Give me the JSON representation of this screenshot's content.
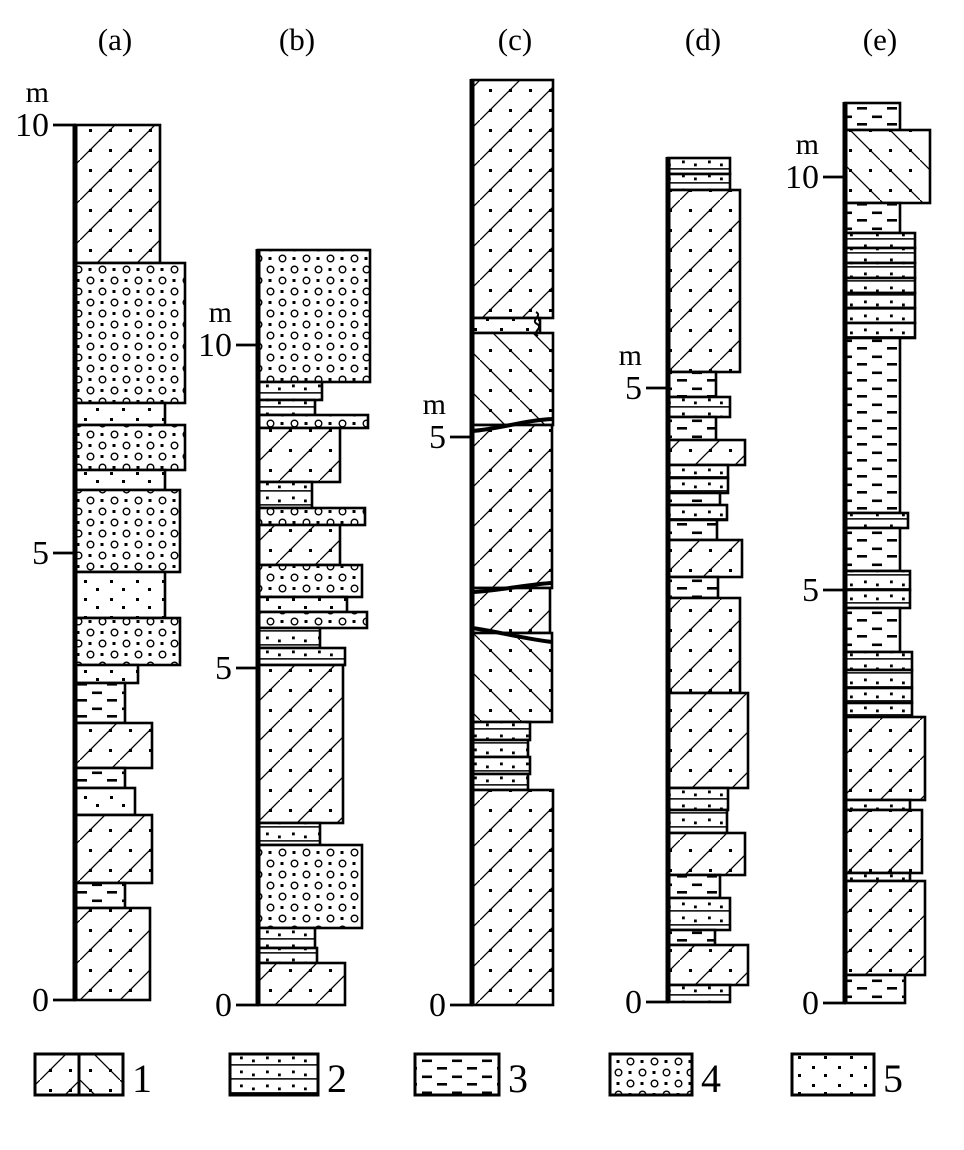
{
  "figure": {
    "unit_label": "m",
    "column_titles": [
      "(a)",
      "(b)",
      "(c)",
      "(d)",
      "(e)"
    ],
    "legend_numbers": [
      "1",
      "2",
      "3",
      "4",
      "5"
    ]
  },
  "chart_data": {
    "type": "stratigraphic-columns",
    "unit": "m",
    "pattern_key": {
      "xr": "diagonal-lines-with-dots-right",
      "xl": "diagonal-lines-with-dots-left",
      "hb": "horizontal-lines-with-dots",
      "si": "short-dashes",
      "cg": "circles-and-dots",
      "sd": "sparse-dots"
    },
    "columns": [
      {
        "name": "a",
        "label": "(a)",
        "x": 75,
        "label_x": 115,
        "ticks": [
          {
            "label": "10",
            "y": 125
          },
          {
            "label": "5",
            "y": 553
          },
          {
            "label": "0",
            "y": 1000
          }
        ],
        "layers": [
          [
            125,
            263,
            160,
            "xr"
          ],
          [
            263,
            403,
            185,
            "cg"
          ],
          [
            403,
            425,
            165,
            "sd"
          ],
          [
            425,
            470,
            185,
            "cg"
          ],
          [
            470,
            490,
            165,
            "sd"
          ],
          [
            490,
            572,
            180,
            "cg"
          ],
          [
            572,
            618,
            165,
            "sd"
          ],
          [
            618,
            665,
            180,
            "cg"
          ],
          [
            665,
            683,
            138,
            "sd"
          ],
          [
            683,
            723,
            125,
            "si"
          ],
          [
            723,
            768,
            152,
            "xr"
          ],
          [
            768,
            788,
            125,
            "si"
          ],
          [
            788,
            815,
            135,
            "sd"
          ],
          [
            815,
            883,
            152,
            "xr"
          ],
          [
            883,
            908,
            125,
            "si"
          ],
          [
            908,
            1000,
            150,
            "xr"
          ]
        ]
      },
      {
        "name": "b",
        "label": "(b)",
        "x": 258,
        "label_x": 297,
        "ticks": [
          {
            "label": "10",
            "y": 345
          },
          {
            "label": "5",
            "y": 668
          },
          {
            "label": "0",
            "y": 1005
          }
        ],
        "layers": [
          [
            250,
            382,
            370,
            "cg"
          ],
          [
            382,
            400,
            322,
            "hb"
          ],
          [
            400,
            415,
            315,
            "hb"
          ],
          [
            415,
            428,
            368,
            "cg"
          ],
          [
            428,
            482,
            340,
            "xr"
          ],
          [
            482,
            508,
            312,
            "hb"
          ],
          [
            508,
            525,
            365,
            "cg"
          ],
          [
            525,
            565,
            340,
            "xr"
          ],
          [
            565,
            597,
            362,
            "cg"
          ],
          [
            597,
            612,
            347,
            "sd"
          ],
          [
            612,
            628,
            367,
            "cg"
          ],
          [
            628,
            648,
            320,
            "hb"
          ],
          [
            648,
            665,
            345,
            "hb"
          ],
          [
            665,
            823,
            343,
            "xr"
          ],
          [
            823,
            845,
            320,
            "hb"
          ],
          [
            845,
            928,
            362,
            "cg"
          ],
          [
            928,
            948,
            315,
            "hb"
          ],
          [
            948,
            963,
            317,
            "hb"
          ],
          [
            963,
            1005,
            345,
            "xr"
          ]
        ]
      },
      {
        "name": "c",
        "label": "(c)",
        "x": 472,
        "label_x": 515,
        "ticks": [
          {
            "label": "5",
            "y": 437
          },
          {
            "label": "0",
            "y": 1005
          }
        ],
        "layers": [
          [
            80,
            318,
            553,
            "xr"
          ],
          [
            318,
            333,
            540,
            "sd"
          ],
          [
            333,
            425,
            553,
            "xl"
          ],
          [
            425,
            588,
            552,
            "xr"
          ],
          [
            588,
            633,
            550,
            "xr"
          ],
          [
            633,
            722,
            552,
            "xl"
          ],
          [
            722,
            740,
            530,
            "hb"
          ],
          [
            740,
            757,
            528,
            "hb"
          ],
          [
            757,
            774,
            530,
            "hb"
          ],
          [
            774,
            790,
            528,
            "hb"
          ],
          [
            790,
            1005,
            553,
            "xr"
          ]
        ],
        "features": [
          {
            "name": "scour-surface",
            "path": "M472,431 C500,429 525,420 553,419",
            "w": 4
          },
          {
            "name": "scour-surface",
            "path": "M472,592 C498,591 530,584 552,583",
            "w": 4
          },
          {
            "name": "scour-surface",
            "path": "M472,628 C495,631 525,639 552,642",
            "w": 4
          },
          {
            "name": "squiggle",
            "path": "M536,312 c7,4 -6,8 1,12 c7,4 -6,8 1,12",
            "w": 2
          }
        ]
      },
      {
        "name": "d",
        "label": "(d)",
        "x": 668,
        "label_x": 703,
        "ticks": [
          {
            "label": "5",
            "y": 388
          },
          {
            "label": "0",
            "y": 1002
          }
        ],
        "layers": [
          [
            158,
            174,
            730,
            "hb"
          ],
          [
            174,
            190,
            730,
            "hb"
          ],
          [
            190,
            372,
            740,
            "xr"
          ],
          [
            372,
            397,
            716,
            "si"
          ],
          [
            397,
            417,
            730,
            "hb"
          ],
          [
            417,
            440,
            716,
            "si"
          ],
          [
            440,
            465,
            745,
            "xr"
          ],
          [
            465,
            478,
            728,
            "hb"
          ],
          [
            478,
            493,
            728,
            "hb"
          ],
          [
            493,
            505,
            720,
            "si"
          ],
          [
            505,
            520,
            727,
            "hb"
          ],
          [
            520,
            540,
            717,
            "si"
          ],
          [
            540,
            577,
            742,
            "xr"
          ],
          [
            577,
            598,
            718,
            "si"
          ],
          [
            598,
            693,
            740,
            "xr"
          ],
          [
            693,
            788,
            748,
            "xr"
          ],
          [
            788,
            810,
            728,
            "hb"
          ],
          [
            810,
            833,
            727,
            "hb"
          ],
          [
            833,
            875,
            745,
            "xr"
          ],
          [
            875,
            898,
            720,
            "si"
          ],
          [
            898,
            930,
            730,
            "hb"
          ],
          [
            930,
            945,
            715,
            "si"
          ],
          [
            945,
            985,
            748,
            "xr"
          ],
          [
            985,
            1002,
            730,
            "hb"
          ]
        ]
      },
      {
        "name": "e",
        "label": "(e)",
        "x": 845,
        "label_x": 880,
        "ticks": [
          {
            "label": "10",
            "y": 177
          },
          {
            "label": "5",
            "y": 590
          },
          {
            "label": "0",
            "y": 1003
          }
        ],
        "layers": [
          [
            103,
            130,
            900,
            "si"
          ],
          [
            130,
            203,
            930,
            "xl"
          ],
          [
            203,
            233,
            900,
            "si"
          ],
          [
            233,
            248,
            915,
            "hb"
          ],
          [
            248,
            263,
            915,
            "hb"
          ],
          [
            263,
            278,
            915,
            "hb"
          ],
          [
            278,
            293,
            915,
            "hb"
          ],
          [
            293,
            308,
            915,
            "hb"
          ],
          [
            308,
            323,
            915,
            "hb"
          ],
          [
            323,
            338,
            915,
            "hb"
          ],
          [
            338,
            513,
            900,
            "si"
          ],
          [
            513,
            528,
            908,
            "hb"
          ],
          [
            528,
            571,
            900,
            "si"
          ],
          [
            571,
            590,
            910,
            "hb"
          ],
          [
            590,
            608,
            910,
            "hb"
          ],
          [
            608,
            652,
            900,
            "si"
          ],
          [
            652,
            670,
            912,
            "hb"
          ],
          [
            670,
            688,
            912,
            "hb"
          ],
          [
            688,
            703,
            912,
            "hb"
          ],
          [
            703,
            717,
            912,
            "hb"
          ],
          [
            717,
            800,
            925,
            "xr"
          ],
          [
            800,
            810,
            910,
            "hb"
          ],
          [
            810,
            873,
            922,
            "xr"
          ],
          [
            873,
            881,
            910,
            "hb"
          ],
          [
            881,
            975,
            925,
            "xr"
          ],
          [
            975,
            1003,
            905,
            "si"
          ]
        ]
      }
    ],
    "legend": [
      {
        "label": "1",
        "pattern": "split-xr-xl",
        "x": 35,
        "y": 1054,
        "w": 88,
        "h": 41,
        "label_x": 132
      },
      {
        "label": "2",
        "pattern": "hb",
        "x": 230,
        "y": 1054,
        "w": 88,
        "h": 41,
        "label_x": 327
      },
      {
        "label": "3",
        "pattern": "si",
        "x": 415,
        "y": 1054,
        "w": 84,
        "h": 41,
        "label_x": 508
      },
      {
        "label": "4",
        "pattern": "cg",
        "x": 610,
        "y": 1054,
        "w": 82,
        "h": 41,
        "label_x": 701
      },
      {
        "label": "5",
        "pattern": "sd",
        "x": 792,
        "y": 1054,
        "w": 82,
        "h": 41,
        "label_x": 883
      }
    ],
    "layout": {
      "width": 964,
      "height": 1150,
      "title_baseline_y": 50,
      "legend_label_baseline_y": 1092
    }
  }
}
